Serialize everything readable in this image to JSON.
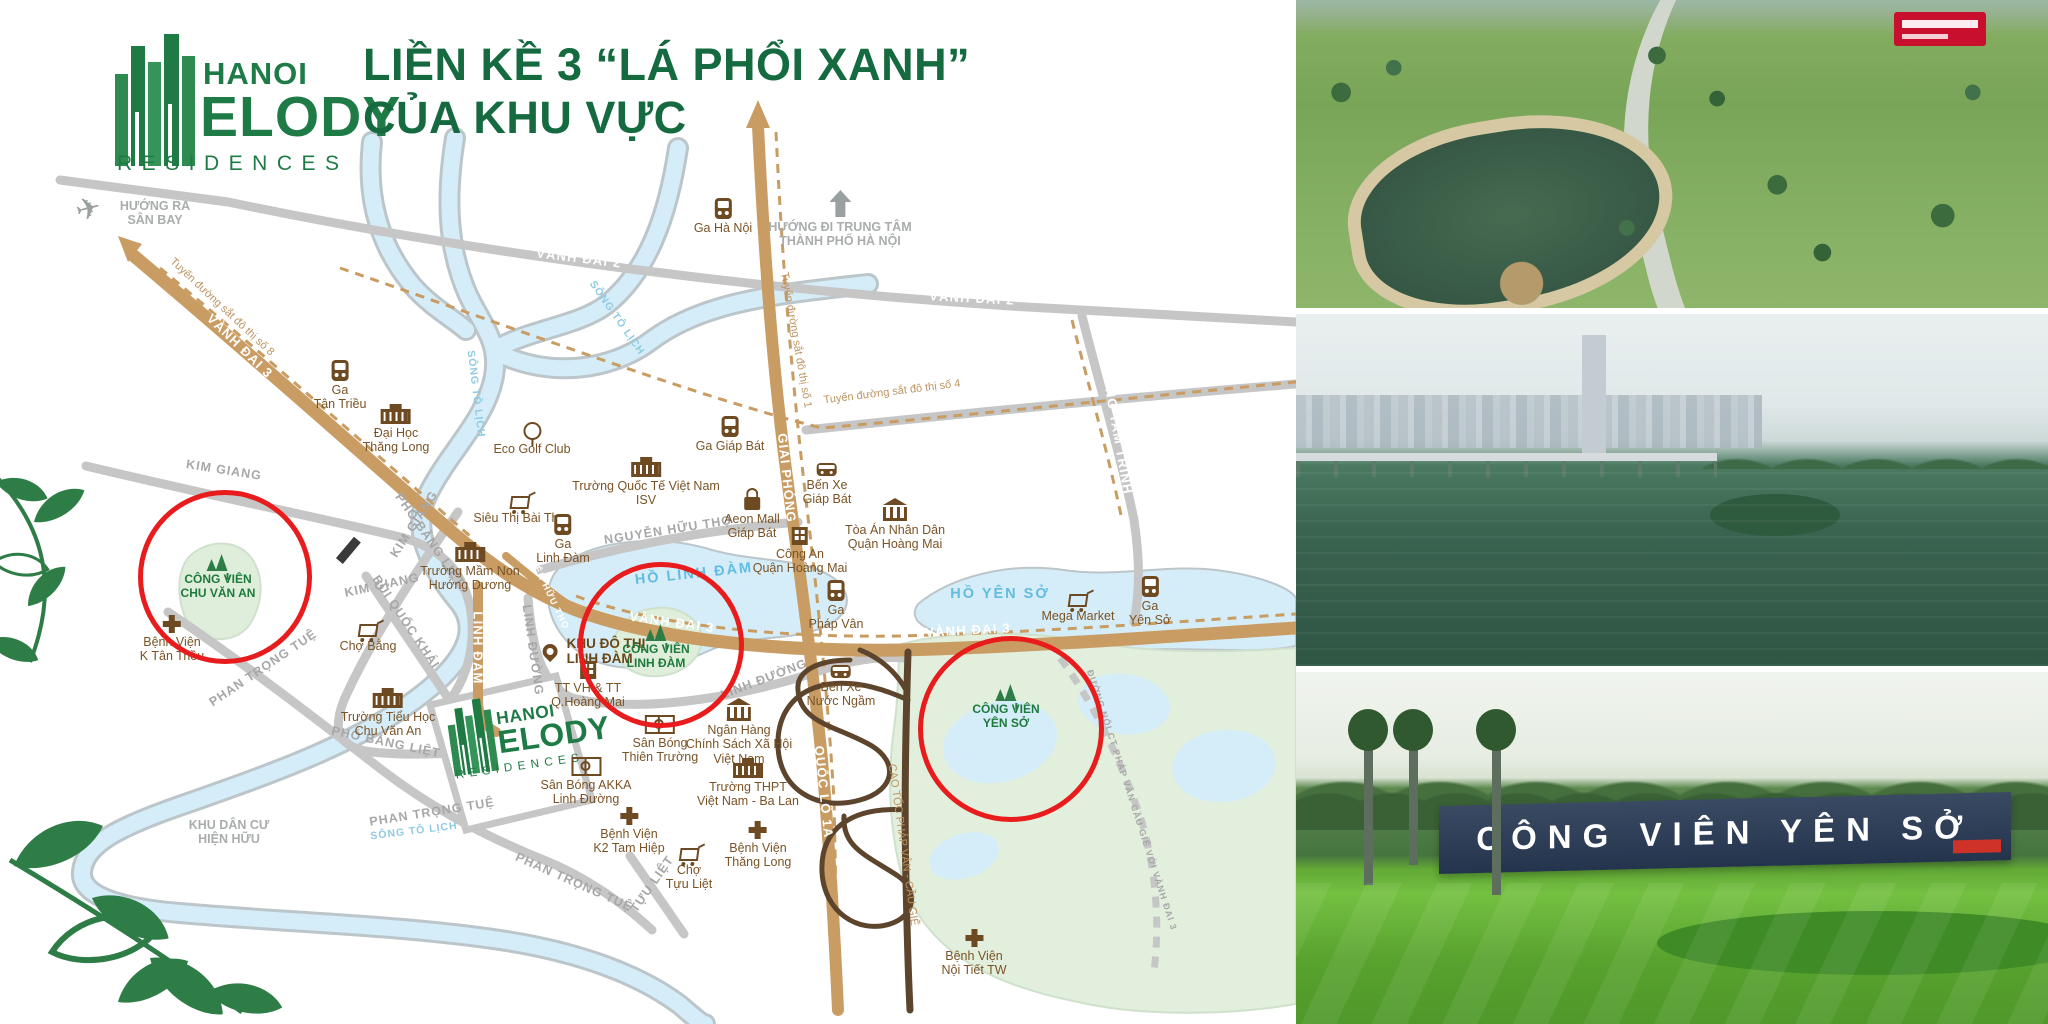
{
  "brand": {
    "hanoi": "HANOI",
    "melody": "ELODY",
    "residences": "RESIDENCES"
  },
  "headline": {
    "line1": "LIỀN KỀ 3 “LÁ PHỔI XANH”",
    "line2": "CỦA KHU VỰC"
  },
  "colors": {
    "brand_green": "#1e7b45",
    "headline_green": "#156a40",
    "highlight_red": "#e81c1c",
    "road_tan": "#c99c63",
    "water_blue": "#d5edf8",
    "park_green": "#dfeeda"
  },
  "map": {
    "road_labels": [
      {
        "text": "VÀNH ĐAI 2",
        "x": 579,
        "y": 258,
        "rot": 7,
        "cls": "rw"
      },
      {
        "text": "VÀNH ĐAI 2",
        "x": 972,
        "y": 298,
        "rot": 3,
        "cls": "rw"
      },
      {
        "text": "VÀNH ĐAI 2.5",
        "x": 930,
        "y": 404,
        "rot": -6,
        "cls": "rw"
      },
      {
        "text": "VÀNH ĐAI 3",
        "x": 240,
        "y": 346,
        "rot": 44,
        "cls": "rw"
      },
      {
        "text": "VÀNH ĐAI 3",
        "x": 672,
        "y": 622,
        "rot": 8,
        "cls": "rw"
      },
      {
        "text": "VÀNH ĐAI 3",
        "x": 968,
        "y": 630,
        "rot": -3,
        "cls": "rw"
      },
      {
        "text": "GIẢI PHÓNG",
        "x": 787,
        "y": 478,
        "rot": 84,
        "cls": "rw"
      },
      {
        "text": "QUỐC LỘ 1A",
        "x": 824,
        "y": 792,
        "rot": 84,
        "cls": "rw"
      },
      {
        "text": "LINH ĐÀM",
        "x": 478,
        "y": 648,
        "rot": 90,
        "cls": "rw"
      },
      {
        "text": "NGUYỄN HỮU THỌ",
        "x": 545,
        "y": 584,
        "rot": 64,
        "cls": "rw sm"
      },
      {
        "text": "ĐƯỜNG TAM TRINH",
        "x": 1116,
        "y": 424,
        "rot": 80,
        "cls": "rw"
      },
      {
        "text": "KIM GIANG",
        "x": 224,
        "y": 470,
        "rot": 9,
        "cls": "rg"
      },
      {
        "text": "KIM GIANG",
        "x": 414,
        "y": 524,
        "rot": -57,
        "cls": "rg"
      },
      {
        "text": "KIM GIANG",
        "x": 382,
        "y": 585,
        "rot": -12,
        "cls": "rg"
      },
      {
        "text": "NGUYỄN HỮU THỌ",
        "x": 668,
        "y": 530,
        "rot": -9,
        "cls": "rg"
      },
      {
        "text": "LINH ĐƯỜNG",
        "x": 533,
        "y": 650,
        "rot": 82,
        "cls": "rg"
      },
      {
        "text": "LINH ĐƯỜNG",
        "x": 764,
        "y": 679,
        "rot": -21,
        "cls": "rg"
      },
      {
        "text": "BÙI QUỐC KHÁI",
        "x": 406,
        "y": 622,
        "rot": 56,
        "cls": "rg"
      },
      {
        "text": "PHỐ BẰNG LIỆT",
        "x": 430,
        "y": 540,
        "rot": 55,
        "cls": "rg"
      },
      {
        "text": "PHỐ BẰNG LIỆT",
        "x": 386,
        "y": 742,
        "rot": 12,
        "cls": "rg"
      },
      {
        "text": "PHAN TRỌNG TUỆ",
        "x": 263,
        "y": 668,
        "rot": -34,
        "cls": "rg"
      },
      {
        "text": "PHAN TRỌNG TUỆ",
        "x": 432,
        "y": 812,
        "rot": -9,
        "cls": "rg"
      },
      {
        "text": "PHAN TRỌNG TUỆ",
        "x": 574,
        "y": 882,
        "rot": 24,
        "cls": "rg"
      },
      {
        "text": "TỰU LIỆT",
        "x": 652,
        "y": 884,
        "rot": -55,
        "cls": "rg"
      },
      {
        "text": "SÔNG TÔ LỊCH",
        "x": 617,
        "y": 318,
        "rot": 55,
        "cls": "rv"
      },
      {
        "text": "SÔNG TÔ LỊCH",
        "x": 476,
        "y": 394,
        "rot": 83,
        "cls": "rv"
      },
      {
        "text": "SÔNG TÔ LỊCH",
        "x": 414,
        "y": 831,
        "rot": -7,
        "cls": "rv"
      },
      {
        "text": "HỒ LINH ĐÀM",
        "x": 694,
        "y": 574,
        "rot": -6,
        "cls": "lk"
      },
      {
        "text": "HỒ YÊN SỞ",
        "x": 1000,
        "y": 594,
        "rot": 0,
        "cls": "lk"
      },
      {
        "text": "Tuyến đường sắt đô thị số 8",
        "x": 222,
        "y": 307,
        "rot": 43,
        "cls": "rb"
      },
      {
        "text": "Tuyến đường sắt đô thị số 1",
        "x": 796,
        "y": 340,
        "rot": 80,
        "cls": "rb"
      },
      {
        "text": "Tuyến đường sắt đô thị số 4",
        "x": 892,
        "y": 392,
        "rot": -7,
        "cls": "rb"
      },
      {
        "text": "CAO TỐC PHÁP VÂN - CẦU GIẼ",
        "x": 903,
        "y": 845,
        "rot": 82,
        "cls": "rb"
      },
      {
        "text": "ĐƯỜNG NỐI CT PHÁP VÂN CẦU GIẼ VỚI VÀNH ĐAI 3",
        "x": 1132,
        "y": 800,
        "rot": 72,
        "cls": "rg sm"
      }
    ],
    "landmarks": [
      {
        "type": "plane",
        "label": "HƯỚNG RA\nSÂN BAY",
        "x": 133,
        "y": 196
      },
      {
        "type": "arrow",
        "label": "HƯỚNG ĐI TRUNG TÂM\nTHÀNH PHỐ HÀ NỘI",
        "x": 840,
        "y": 190
      },
      {
        "type": "train",
        "label": "Ga Hà Nội",
        "x": 723,
        "y": 198
      },
      {
        "type": "train",
        "label": "Ga\nTân Triều",
        "x": 340,
        "y": 360
      },
      {
        "type": "school",
        "label": "Đại Học\nThăng Long",
        "x": 396,
        "y": 402
      },
      {
        "type": "golf",
        "label": "Eco Golf Club",
        "x": 532,
        "y": 422
      },
      {
        "type": "school",
        "label": "Trường Quốc Tế Việt Nam\nISV",
        "x": 646,
        "y": 455
      },
      {
        "type": "train",
        "label": "Ga Giáp Bát",
        "x": 730,
        "y": 416
      },
      {
        "type": "cart",
        "label": "Siêu Thị Bài Thơ",
        "x": 520,
        "y": 490
      },
      {
        "type": "bag",
        "label": "Aeon Mall\nGiáp Bát",
        "x": 752,
        "y": 488
      },
      {
        "type": "bus",
        "label": "Bến Xe\nGiáp Bát",
        "x": 827,
        "y": 458
      },
      {
        "type": "bank",
        "label": "Tòa Án Nhân Dân\nQuận Hoàng Mai",
        "x": 895,
        "y": 498
      },
      {
        "type": "train",
        "label": "Ga\nLinh Đàm",
        "x": 563,
        "y": 514
      },
      {
        "type": "building",
        "label": "Công An\nQuận Hoàng Mai",
        "x": 800,
        "y": 524
      },
      {
        "type": "school",
        "label": "Trường Mầm Non\nHướng Dương",
        "x": 470,
        "y": 540
      },
      {
        "type": "train",
        "label": "Ga\nPháp Vân",
        "x": 836,
        "y": 580
      },
      {
        "type": "train",
        "label": "Ga\nYên Sở",
        "x": 1150,
        "y": 576
      },
      {
        "type": "cart",
        "label": "Mega Market",
        "x": 1078,
        "y": 588
      },
      {
        "type": "pin",
        "label": "KHU ĐÔ THỊ\nLINH ĐÀM",
        "x": 592,
        "y": 636
      },
      {
        "type": "building",
        "label": "TT VH & TT\nQ.Hoàng Mai",
        "x": 588,
        "y": 658
      },
      {
        "type": "bus",
        "label": "Bến Xe\nNước Ngầm",
        "x": 841,
        "y": 660
      },
      {
        "type": "park",
        "label": "CÔNG VIÊN\nCHU VĂN AN",
        "x": 218,
        "y": 552
      },
      {
        "type": "park",
        "label": "CÔNG VIÊN\nLINH ĐÀM",
        "x": 656,
        "y": 622
      },
      {
        "type": "park",
        "label": "CÔNG VIÊN\nYÊN SỞ",
        "x": 1006,
        "y": 682
      },
      {
        "type": "cart",
        "label": "Chợ Bằng",
        "x": 368,
        "y": 618
      },
      {
        "type": "hospital",
        "label": "Bệnh Viện\nK Tân Triều",
        "x": 172,
        "y": 612
      },
      {
        "type": "school",
        "label": "Trường Tiểu Học\nChu Văn An",
        "x": 388,
        "y": 686
      },
      {
        "type": "field",
        "label": "Sân Bóng AKKA\nLinh Đường",
        "x": 586,
        "y": 752
      },
      {
        "type": "field",
        "label": "Sân Bóng\nThiên Trường",
        "x": 660,
        "y": 710
      },
      {
        "type": "bank",
        "label": "Ngân Hàng\nChính Sách Xã Hội\nViệt Nam",
        "x": 739,
        "y": 698
      },
      {
        "type": "school",
        "label": "Trường THPT\nViệt Nam - Ba Lan",
        "x": 748,
        "y": 756
      },
      {
        "type": "hospital",
        "label": "Bệnh Viện\nK2 Tam Hiệp",
        "x": 629,
        "y": 804
      },
      {
        "type": "cart",
        "label": "Chợ\nTựu Liệt",
        "x": 689,
        "y": 842
      },
      {
        "type": "hospital",
        "label": "Bệnh Viện\nThăng Long",
        "x": 758,
        "y": 818
      },
      {
        "type": "hospital",
        "label": "Bệnh Viện\nNội Tiết TW",
        "x": 974,
        "y": 926
      },
      {
        "type": "note",
        "label": "KHU DÂN CƯ\nHIỆN HỮU",
        "x": 229,
        "y": 818
      }
    ],
    "highlights": [
      {
        "x": 220,
        "y": 572,
        "r": 82
      },
      {
        "x": 656,
        "y": 640,
        "r": 78
      },
      {
        "x": 1006,
        "y": 724,
        "r": 88
      }
    ]
  },
  "photos": [
    {
      "name": "aerial-park-photo"
    },
    {
      "name": "lake-skyline-photo"
    },
    {
      "name": "yen-so-sign-photo",
      "sign_text": "CÔNG VIÊN YÊN SỞ"
    }
  ]
}
